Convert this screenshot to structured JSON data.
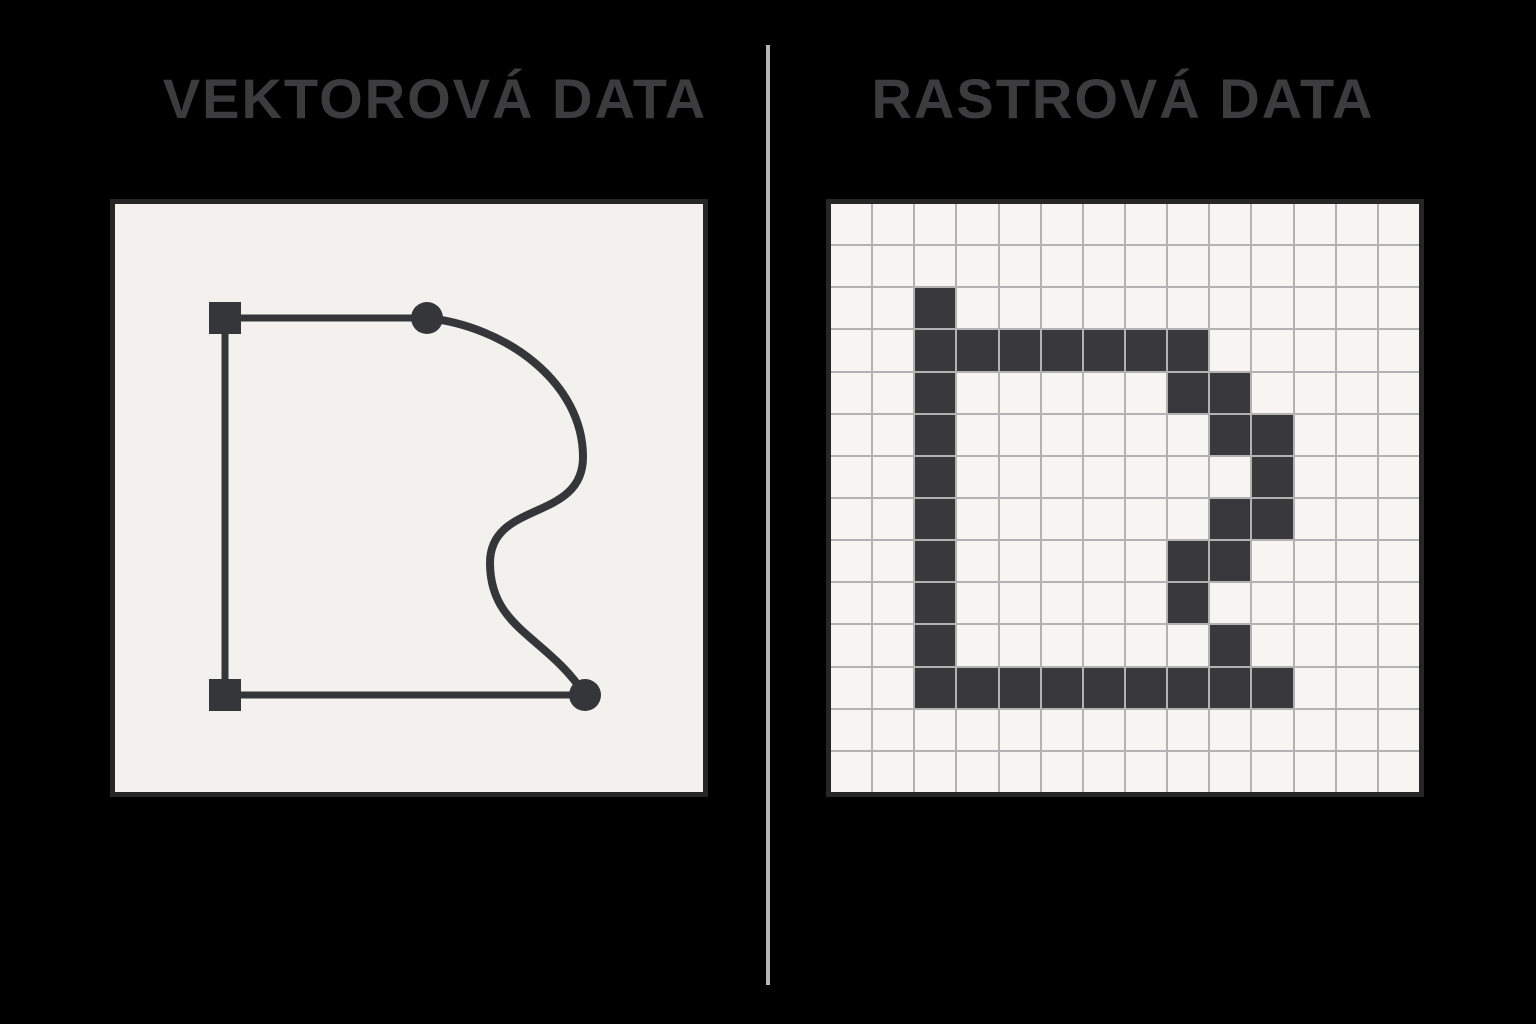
{
  "meta": {
    "background_color": "#000000",
    "canvas_width": 1536,
    "canvas_height": 1024
  },
  "divider": {
    "x": 766,
    "top": 45,
    "height": 940,
    "width": 4,
    "color": "#b4b6b6"
  },
  "left_panel": {
    "title": "VEKTOROVÁ DATA",
    "title_color": "#3c3c3e",
    "title_center_x": 435,
    "card": {
      "x": 110,
      "y": 199,
      "size": 598,
      "background": "#f2f1ee",
      "border_color": "#262626",
      "border_width": 5,
      "vector": {
        "stroke_color": "#35363a",
        "line_width": 7,
        "curve_width": 8,
        "lines": [
          {
            "name": "top-segment",
            "x1": 110,
            "y1": 114,
            "x2": 312,
            "y2": 114
          },
          {
            "name": "left-segment",
            "x1": 110,
            "y1": 110,
            "x2": 110,
            "y2": 491
          },
          {
            "name": "bottom-segment",
            "x1": 110,
            "y1": 491,
            "x2": 470,
            "y2": 491
          }
        ],
        "curve_path": "M 312 114 C 390 122, 468 178, 468 253 C 468 318, 375 296, 375 359 C 375 425, 432 432, 470 491",
        "square_anchors": [
          {
            "cx": 110,
            "cy": 114,
            "size": 32
          },
          {
            "cx": 110,
            "cy": 491,
            "size": 32
          }
        ],
        "round_anchors": [
          {
            "cx": 312,
            "cy": 114,
            "r": 16
          },
          {
            "cx": 470,
            "cy": 491,
            "r": 16
          }
        ]
      }
    }
  },
  "right_panel": {
    "title": "RASTROVÁ DATA",
    "title_color": "#3c3c3e",
    "title_center_x": 1123,
    "card": {
      "x": 826,
      "y": 199,
      "size": 598,
      "background": "#f6f5f2",
      "border_color": "#262626",
      "border_width": 5,
      "grid": {
        "rows": 14,
        "cols": 14,
        "line_color": "#b2b2b2",
        "line_width": 2,
        "cell_color": "#f6f5f2",
        "pixel_color": "#39393b",
        "filled_cells": [
          [
            2,
            2
          ],
          [
            3,
            2
          ],
          [
            3,
            3
          ],
          [
            3,
            4
          ],
          [
            3,
            5
          ],
          [
            3,
            6
          ],
          [
            3,
            7
          ],
          [
            3,
            8
          ],
          [
            4,
            2
          ],
          [
            4,
            8
          ],
          [
            4,
            9
          ],
          [
            5,
            2
          ],
          [
            5,
            9
          ],
          [
            5,
            10
          ],
          [
            6,
            2
          ],
          [
            6,
            10
          ],
          [
            7,
            2
          ],
          [
            7,
            9
          ],
          [
            7,
            10
          ],
          [
            8,
            2
          ],
          [
            8,
            8
          ],
          [
            8,
            9
          ],
          [
            9,
            2
          ],
          [
            9,
            8
          ],
          [
            10,
            2
          ],
          [
            10,
            9
          ],
          [
            11,
            2
          ],
          [
            11,
            3
          ],
          [
            11,
            4
          ],
          [
            11,
            5
          ],
          [
            11,
            6
          ],
          [
            11,
            7
          ],
          [
            11,
            8
          ],
          [
            11,
            9
          ],
          [
            11,
            10
          ]
        ]
      }
    }
  }
}
